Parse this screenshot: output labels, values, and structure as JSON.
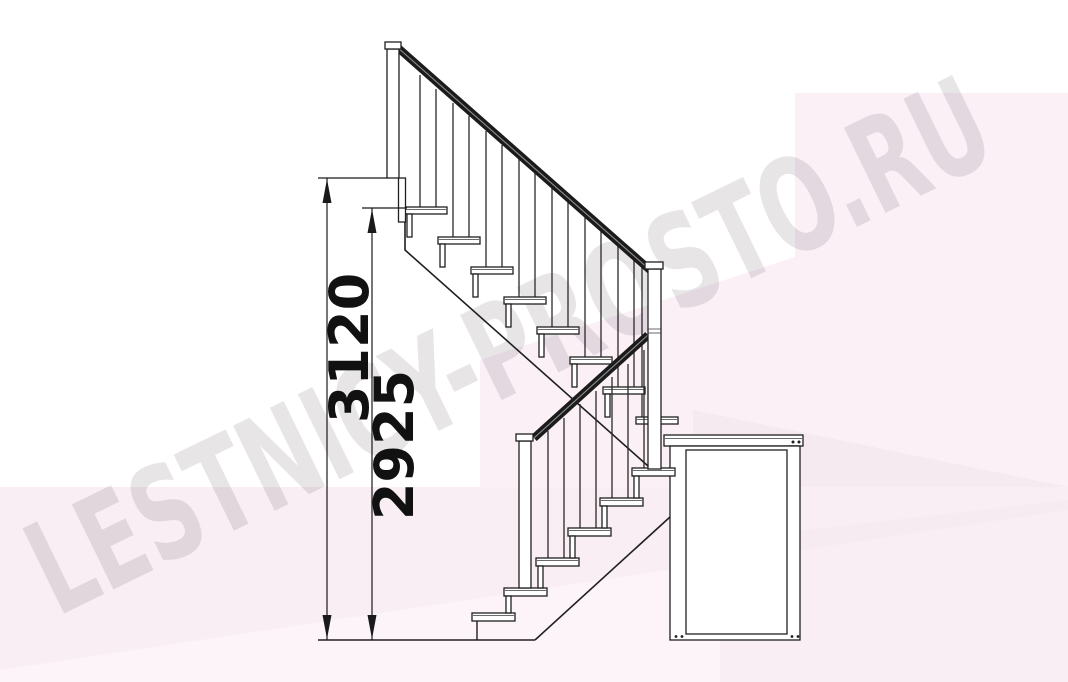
{
  "watermark": {
    "text": "LESTNICY-PROSTO.RU"
  },
  "dimensions": {
    "total_height": {
      "value": "3120"
    },
    "height_to_first_tread": {
      "value": "2925"
    }
  },
  "drawing": {
    "type": "staircase-side-elevation",
    "upper_flight_treads": 8,
    "lower_flight_treads": 6
  },
  "colors": {
    "line": "#1f1f1f",
    "handrail": "#1b1b1b",
    "dimension_text": "#111111",
    "background": "#ffffff",
    "pink_light": "#faf0f6",
    "pink_band": "#f8eef4",
    "pink_dark": "#f3e6ee",
    "watermark": "#5f4a58"
  }
}
